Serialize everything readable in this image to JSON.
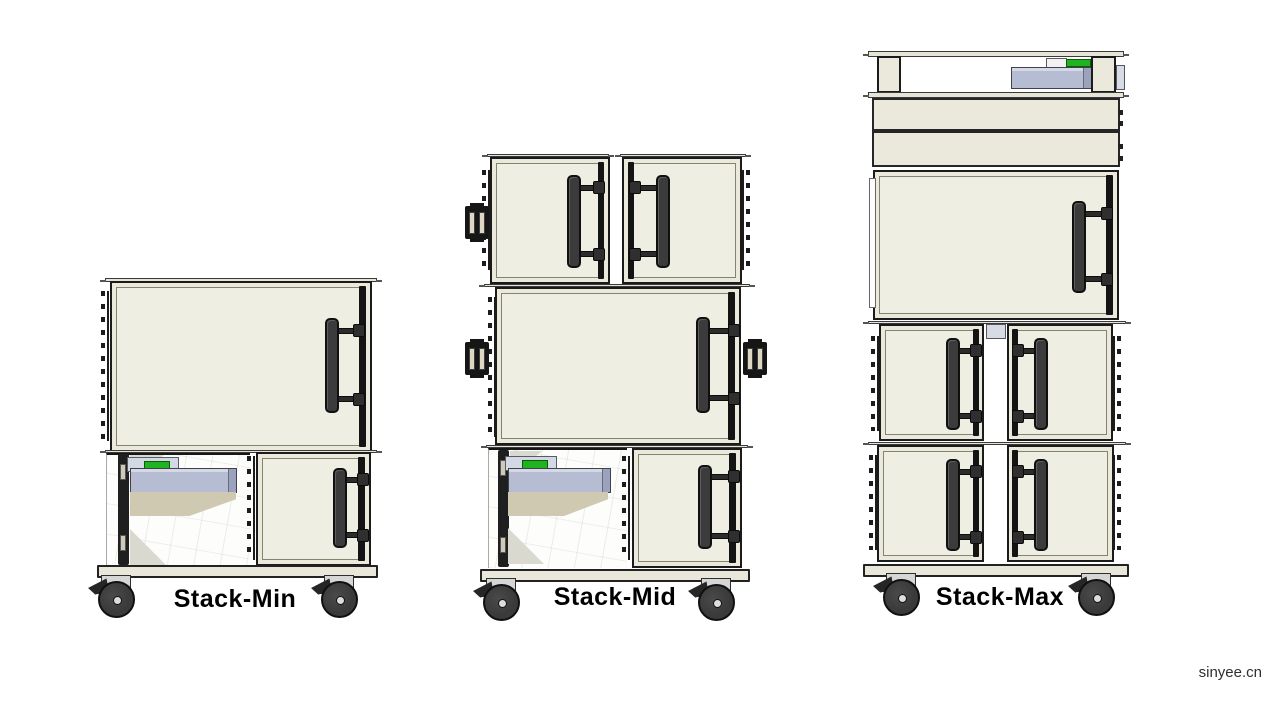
{
  "page": {
    "background": "#ffffff",
    "watermark": "sinyee.cn"
  },
  "figure": {
    "type": "diagram",
    "description": "Three configurations of a modular stacked cabinet cart on casters, shown small to large"
  },
  "stacks": [
    {
      "id": "stack-min",
      "label": "Stack-Min"
    },
    {
      "id": "stack-mid",
      "label": "Stack-Mid"
    },
    {
      "id": "stack-max",
      "label": "Stack-Max"
    }
  ],
  "colors": {
    "cabinet": "#eae9db",
    "cabinet-inner": "#efeee2",
    "outline": "#1b1b1b",
    "handle": "#3b3b3b",
    "rail": "#e5e4d6",
    "tray": "#b6bcd2",
    "tray-face": "#9aa2bd",
    "box-top": "#d3d8e5",
    "chute": "#cfc9b2",
    "green": "#1fb41f",
    "metal": "#d6d6d6",
    "wheel": "#3a3a3a",
    "base": "#e8e7da"
  }
}
